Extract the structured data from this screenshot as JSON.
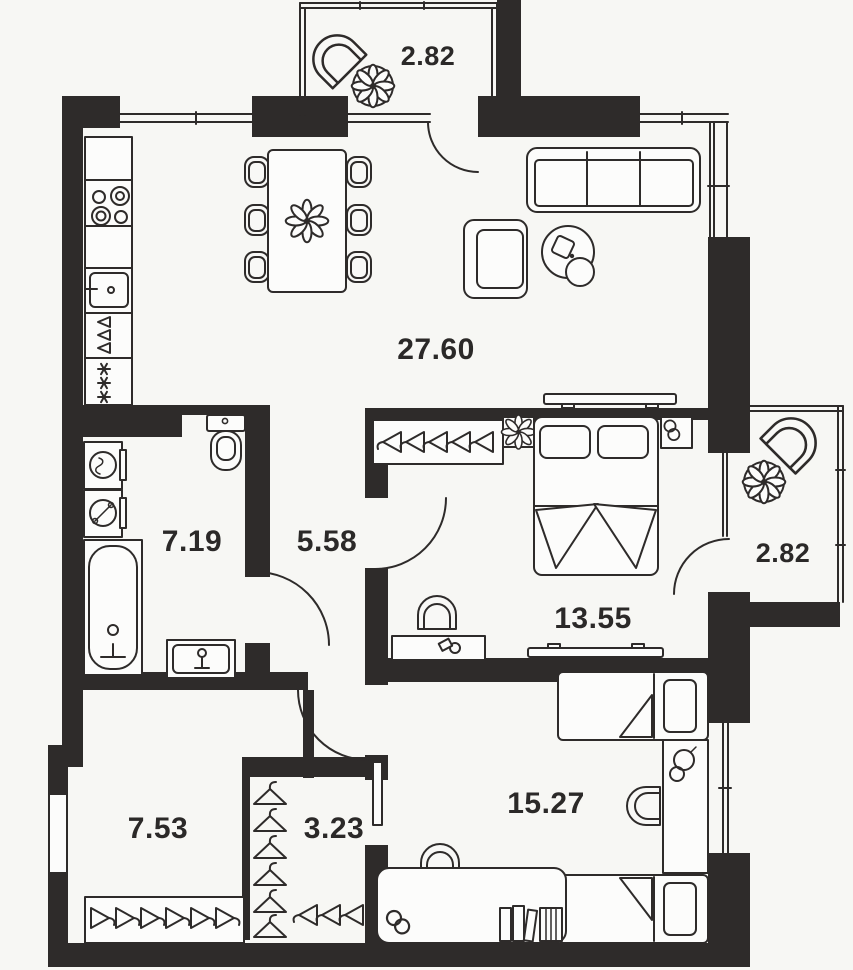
{
  "plan": {
    "type": "apartment-floor-plan",
    "colors": {
      "background": "#f7f7f4",
      "walls": "#2e2b2a",
      "lines": "#2e2b2a",
      "text": "#2b2928"
    },
    "rooms": [
      {
        "id": "balcony-top",
        "area": "2.82"
      },
      {
        "id": "kitchen-living",
        "area": "27.60"
      },
      {
        "id": "bathroom",
        "area": "7.19"
      },
      {
        "id": "hall",
        "area": "5.58"
      },
      {
        "id": "bedroom",
        "area": "13.55"
      },
      {
        "id": "balcony-right",
        "area": "2.82"
      },
      {
        "id": "hallway",
        "area": "7.53"
      },
      {
        "id": "closet",
        "area": "3.23"
      },
      {
        "id": "kids-room",
        "area": "15.27"
      }
    ]
  }
}
